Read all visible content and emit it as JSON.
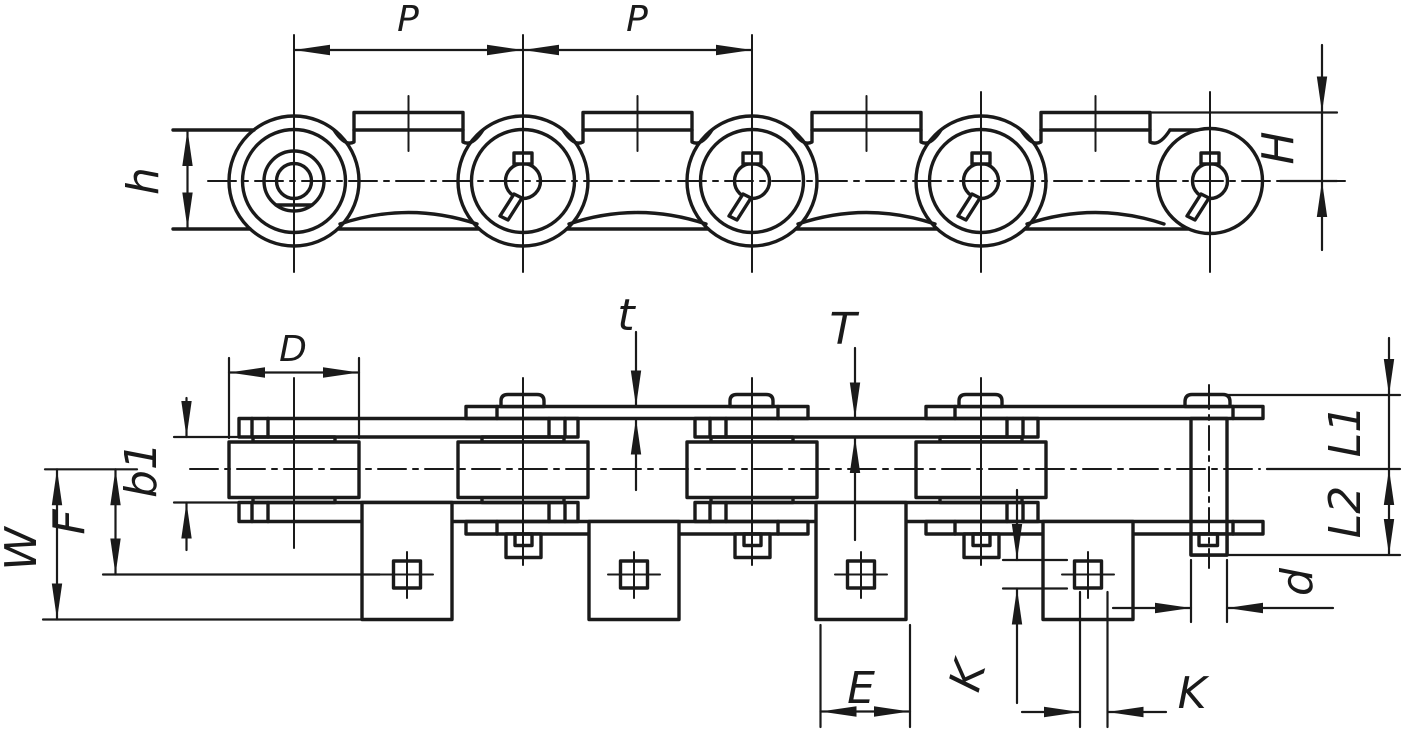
{
  "colors": {
    "ink": "#1a1a1a",
    "paper": "#ffffff"
  },
  "labels": {
    "pitch_left": "P",
    "pitch_right": "P",
    "plate_height": "h",
    "attachment_height": "H",
    "roller_diameter": "D",
    "outer_plate_thickness": "t",
    "inner_plate_thickness": "T",
    "inner_width": "b1",
    "hole_center_offset": "F",
    "attachment_depth": "W",
    "tab_width": "E",
    "hole_size_vertical": "K",
    "hole_size_horizontal": "K",
    "pin_diameter": "d",
    "pin_end_upper": "L1",
    "pin_end_lower": "L2"
  }
}
